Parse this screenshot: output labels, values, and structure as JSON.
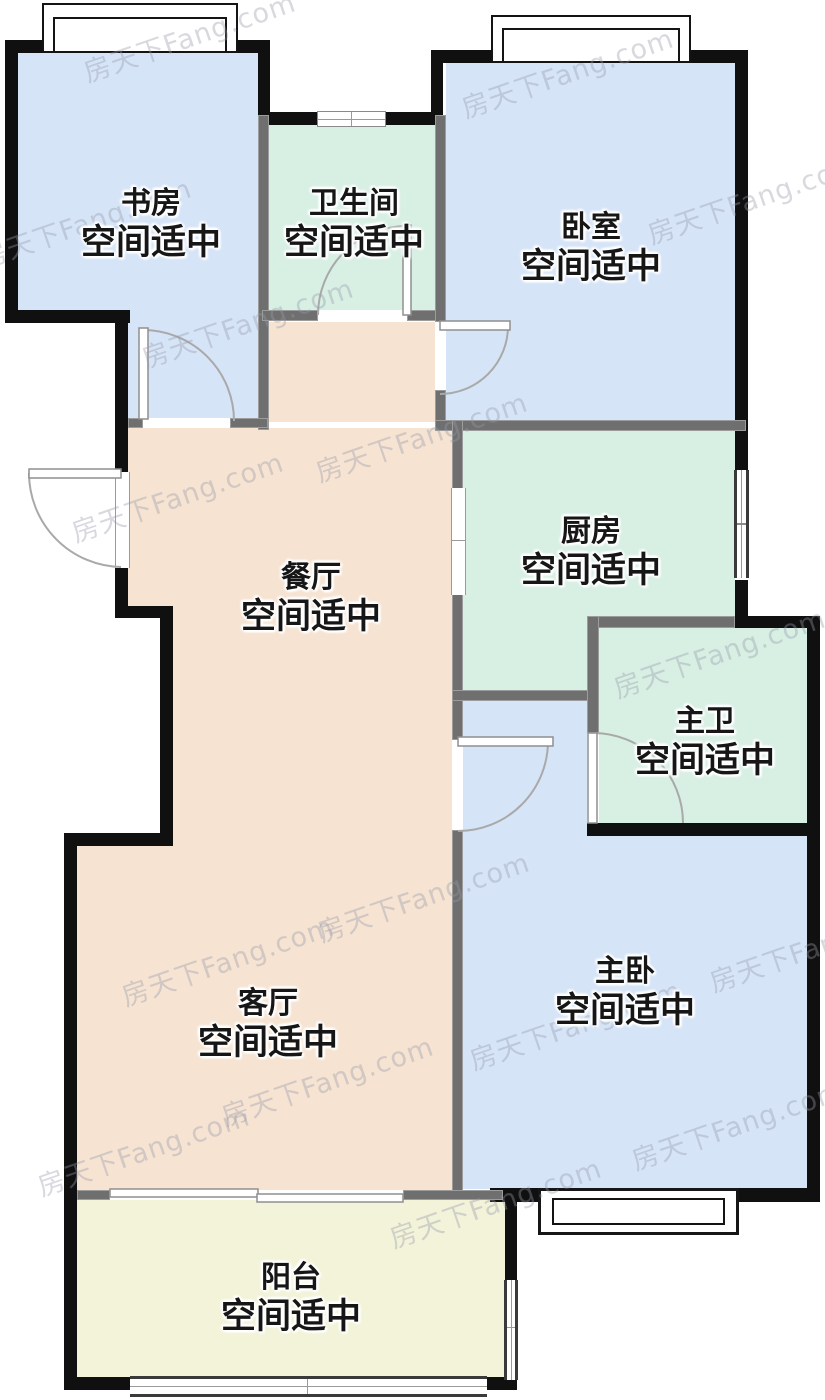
{
  "floorplan": {
    "watermark": {
      "text": "房天下Fang.com"
    },
    "rooms": [
      {
        "id": "study",
        "name": "书房",
        "status": "空间适中"
      },
      {
        "id": "bathroom",
        "name": "卫生间",
        "status": "空间适中"
      },
      {
        "id": "bedroom",
        "name": "卧室",
        "status": "空间适中"
      },
      {
        "id": "dining",
        "name": "餐厅",
        "status": "空间适中"
      },
      {
        "id": "kitchen",
        "name": "厨房",
        "status": "空间适中"
      },
      {
        "id": "master-bath",
        "name": "主卫",
        "status": "空间适中"
      },
      {
        "id": "living",
        "name": "客厅",
        "status": "空间适中"
      },
      {
        "id": "master-bedroom",
        "name": "主卧",
        "status": "空间适中"
      },
      {
        "id": "balcony",
        "name": "阳台",
        "status": "空间适中"
      }
    ],
    "colors": {
      "room_blue": "#d6e4f7",
      "room_green": "#d8efe4",
      "room_beige": "#f6e3d2",
      "room_yellow": "#f3f3da",
      "wall_black": "#101010",
      "wall_gray": "#6f6f6f",
      "outside": "#ffffff"
    }
  }
}
